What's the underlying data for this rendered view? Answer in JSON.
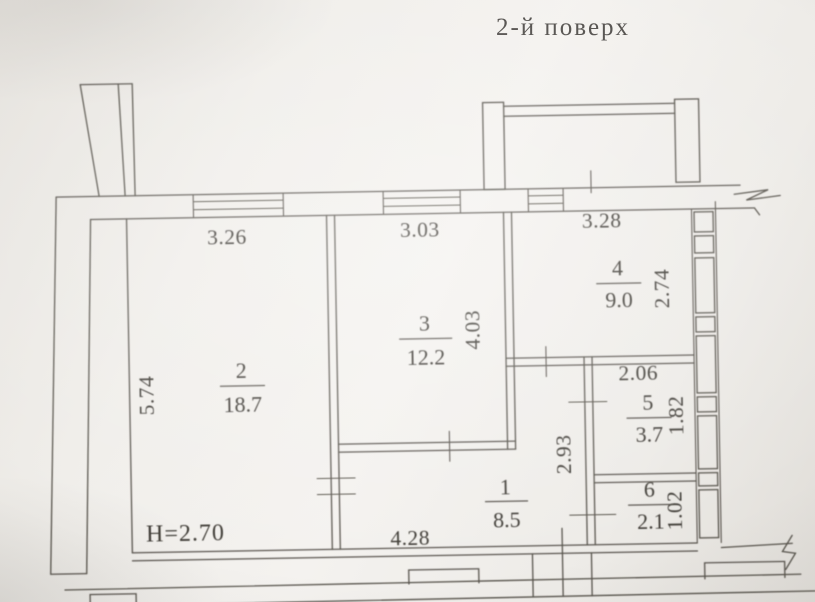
{
  "page": {
    "title": "2-й поверх"
  },
  "floor_plan": {
    "height_note": "H=2.70",
    "rooms": [
      {
        "number": "1",
        "area": "8.5"
      },
      {
        "number": "2",
        "area": "18.7"
      },
      {
        "number": "3",
        "area": "12.2"
      },
      {
        "number": "4",
        "area": "9.0"
      },
      {
        "number": "5",
        "area": "3.7"
      },
      {
        "number": "6",
        "area": "2.1"
      }
    ],
    "dimensions": {
      "room2_top": "3.26",
      "room2_left": "5.74",
      "room3_top": "3.03",
      "room3_right": "4.03",
      "room4_top": "3.28",
      "room4_right": "2.74",
      "room5_top": "2.06",
      "room5_right": "1.82",
      "room6_right": "1.02",
      "hall_left": "2.93",
      "hall_bottom": "4.28"
    }
  }
}
